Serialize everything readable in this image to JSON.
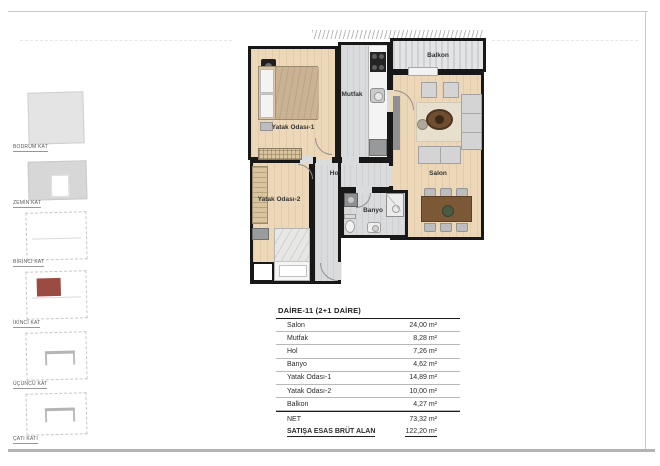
{
  "sidebar": {
    "floors": [
      {
        "label": "BODRUM KAT"
      },
      {
        "label": "ZEMİN KAT"
      },
      {
        "label": "BİRİNCİ KAT"
      },
      {
        "label": "İKİNCİ KAT",
        "highlighted": true
      },
      {
        "label": "ÜÇÜNCÜ KAT"
      },
      {
        "label": "ÇATI KATI"
      }
    ]
  },
  "plan": {
    "rooms": {
      "bedroom1": "Yatak Odası-1",
      "kitchen": "Mutfak",
      "balcony": "Balkon",
      "living": "Salon",
      "hall": "Hol",
      "bath": "Banyo",
      "bedroom2": "Yatak Odası-2"
    }
  },
  "table": {
    "title": "DAİRE-11 (2+1 DAİRE)",
    "rows": [
      {
        "label": "Salon",
        "value": "24,00 m²"
      },
      {
        "label": "Mutfak",
        "value": "8,28 m²"
      },
      {
        "label": "Hol",
        "value": "7,26 m²"
      },
      {
        "label": "Banyo",
        "value": "4,62 m²"
      },
      {
        "label": "Yatak Odası-1",
        "value": "14,89 m²"
      },
      {
        "label": "Yatak Odası-2",
        "value": "10,00 m²"
      },
      {
        "label": "Balkon",
        "value": "4,27 m²"
      }
    ],
    "summary": [
      {
        "label": "NET",
        "value": "73,32 m²"
      },
      {
        "label": "SATIŞA ESAS BRÜT ALAN",
        "value": "122,20 m²"
      }
    ]
  },
  "colors": {
    "highlight_red": "#9c4b41",
    "wood_floor": "#ecd7b8",
    "tile_floor": "#dadbdc",
    "wall": "#181818"
  }
}
